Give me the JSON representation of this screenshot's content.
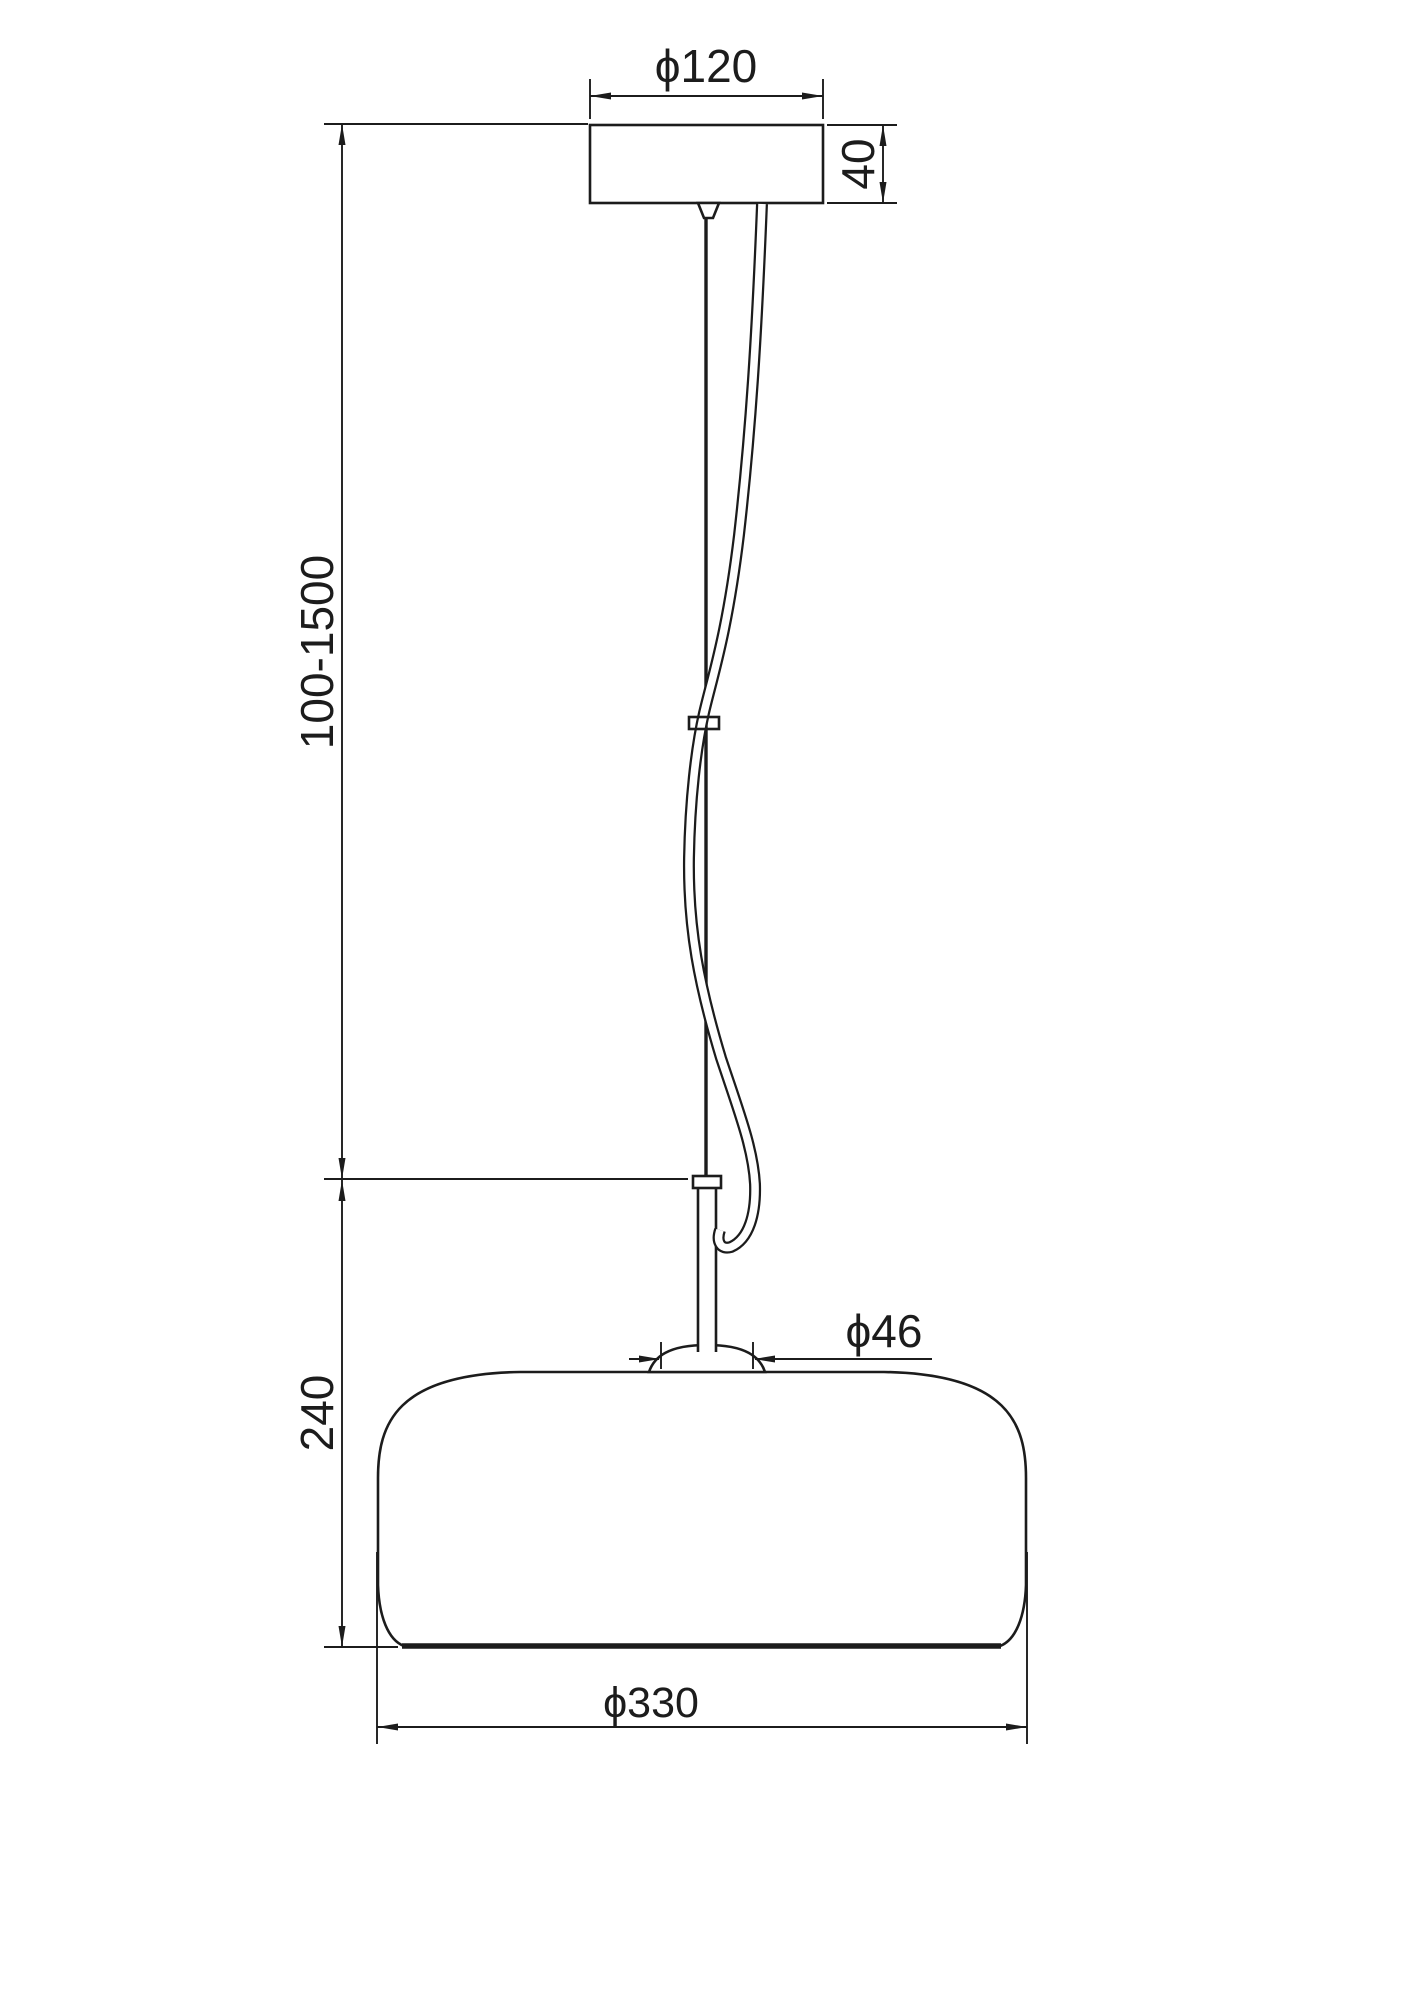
{
  "title": "Pendant lamp technical dimension drawing",
  "colors": {
    "line": "#1c1c1c",
    "background": "#ffffff"
  },
  "labels": {
    "canopy_diameter": "ϕ120",
    "canopy_height": "40",
    "suspension_length": "100-1500",
    "fixture_height": "240",
    "socket_diameter": "ϕ46",
    "shade_diameter": "ϕ330"
  }
}
